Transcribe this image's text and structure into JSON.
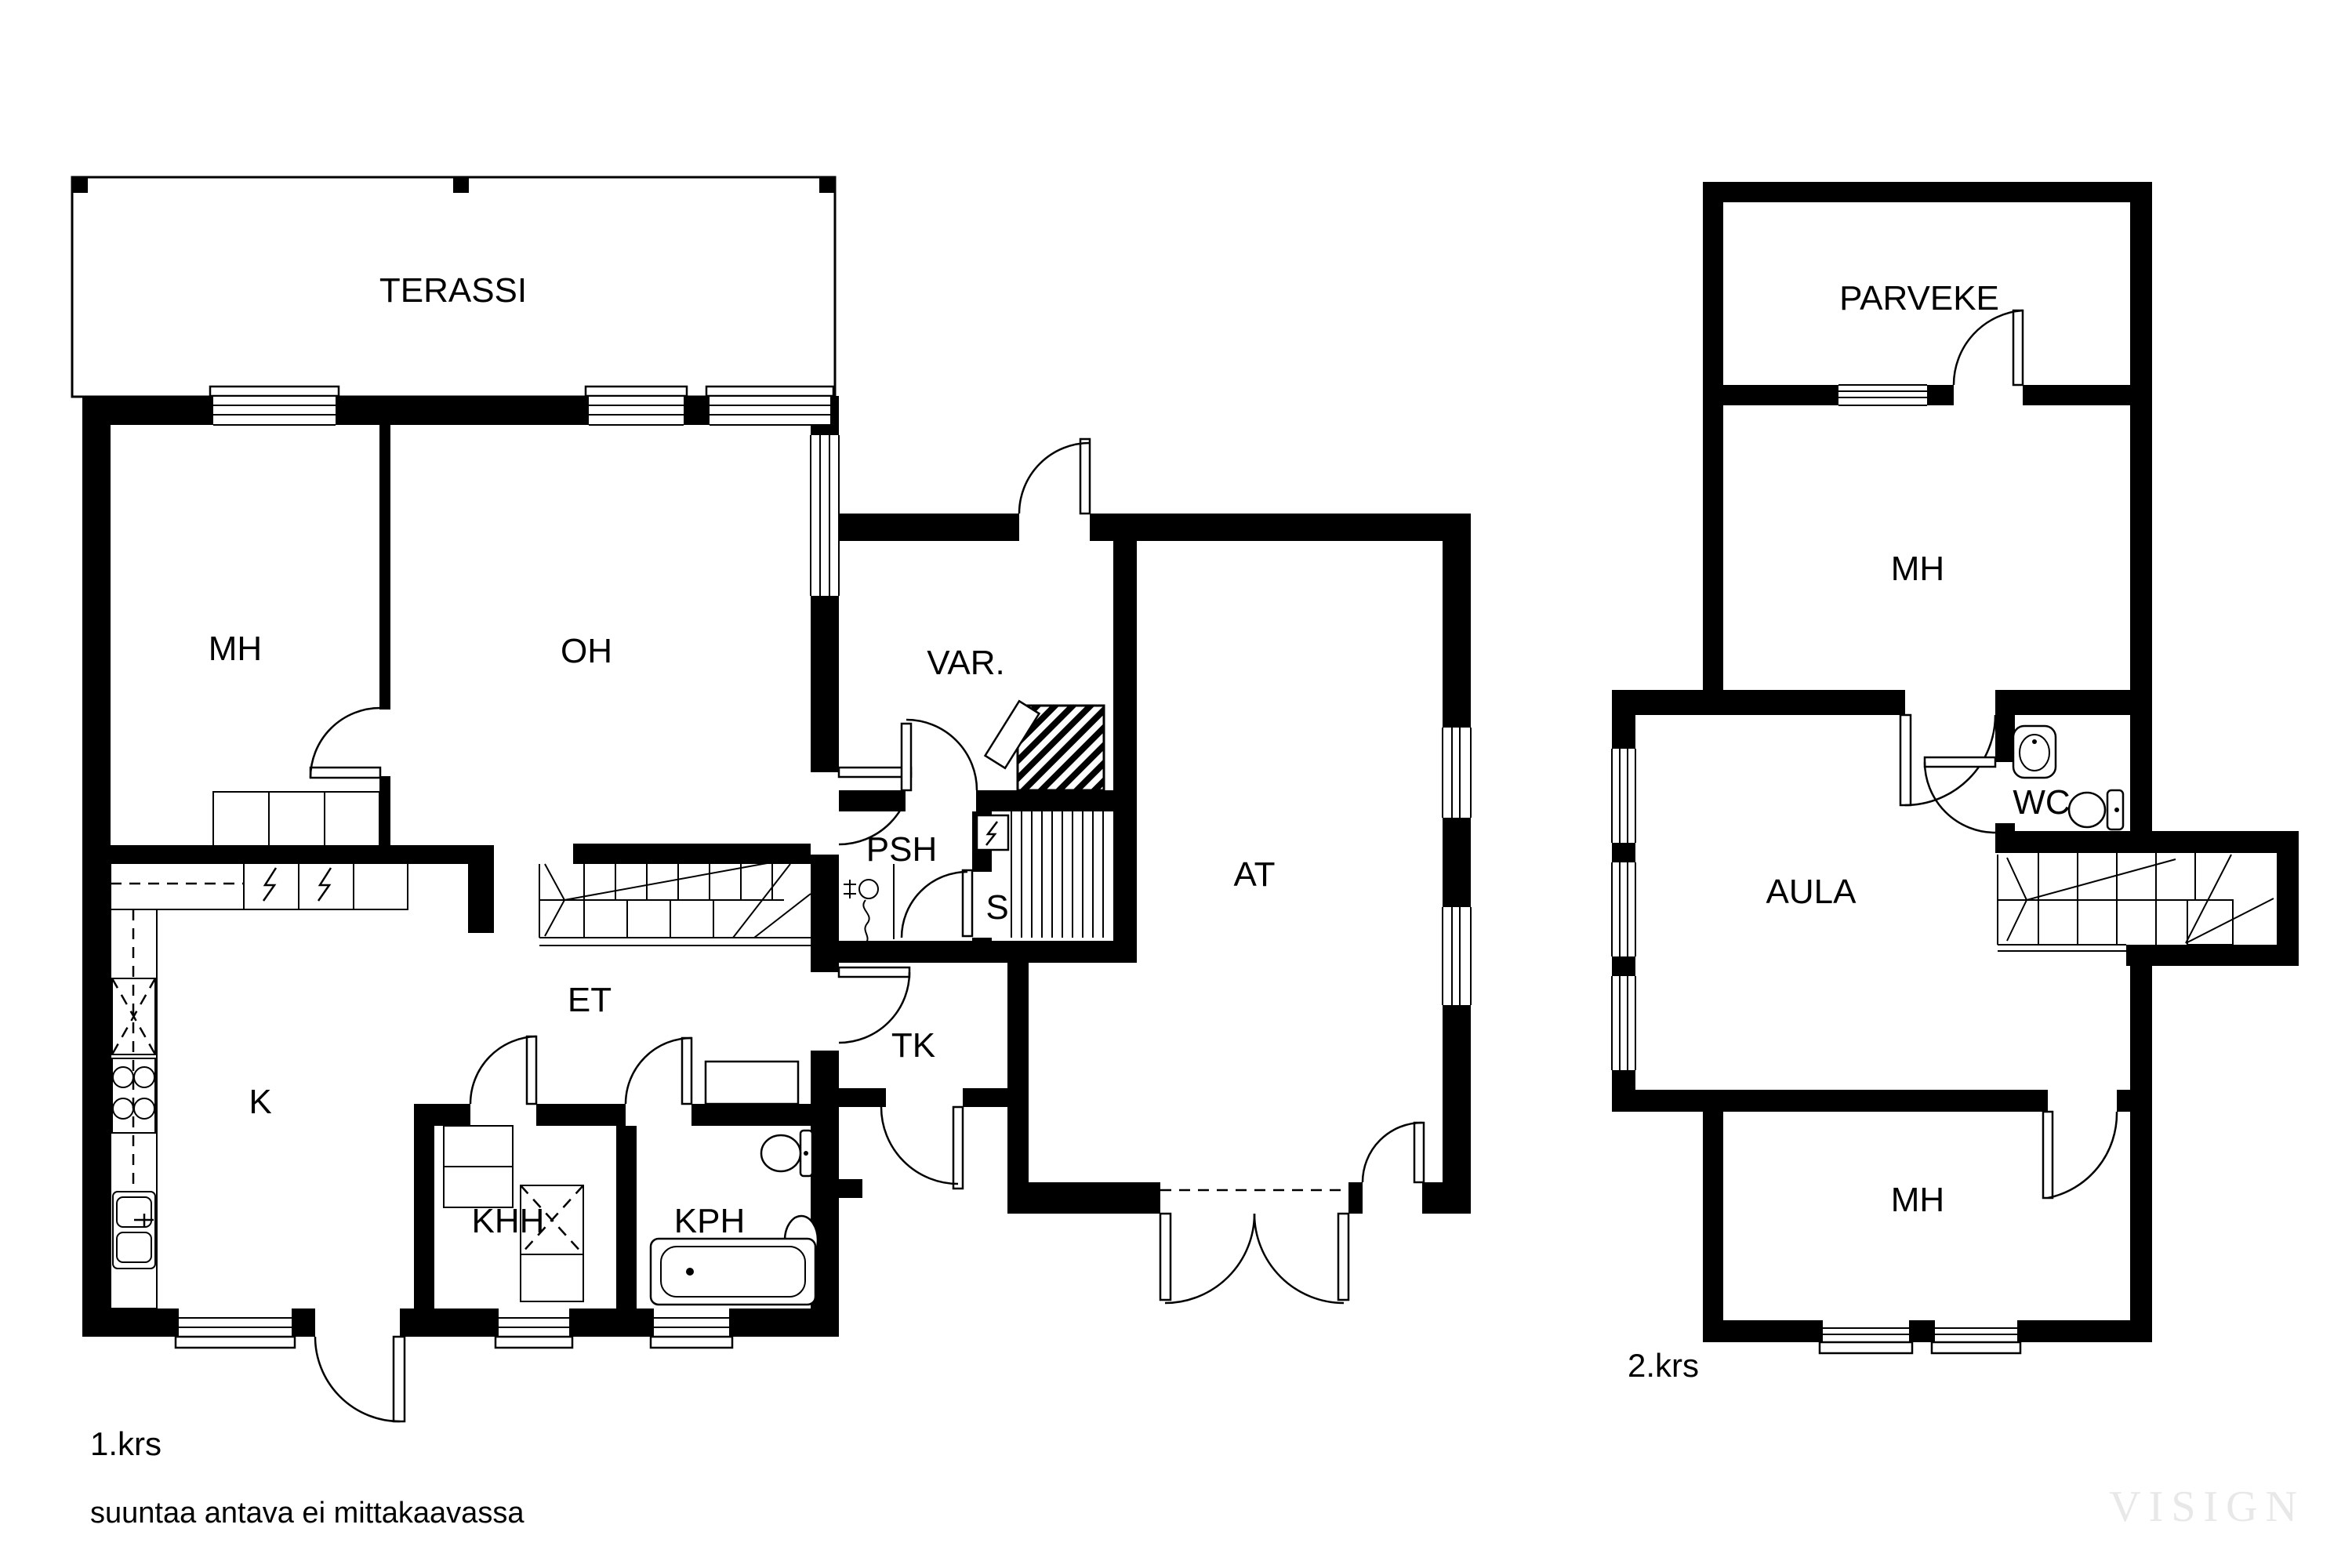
{
  "floor1": {
    "floor_label": "1.krs",
    "rooms": {
      "terassi": "TERASSI",
      "mh": "MH",
      "oh": "OH",
      "var": "VAR.",
      "psh": "PSH",
      "s": "S",
      "at": "AT",
      "et": "ET",
      "tk": "TK",
      "k": "K",
      "khh": "KHH",
      "kph": "KPH"
    }
  },
  "floor2": {
    "floor_label": "2.krs",
    "rooms": {
      "parveke": "PARVEKE",
      "mh_upper": "MH",
      "wc": "WC",
      "aula": "AULA",
      "mh_lower": "MH"
    }
  },
  "disclaimer": "suuntaa antava ei mittakaavassa",
  "watermark": "VISIGN",
  "colors": {
    "walls": "#000000",
    "background": "#ffffff",
    "watermark": "#e8e8e8"
  }
}
